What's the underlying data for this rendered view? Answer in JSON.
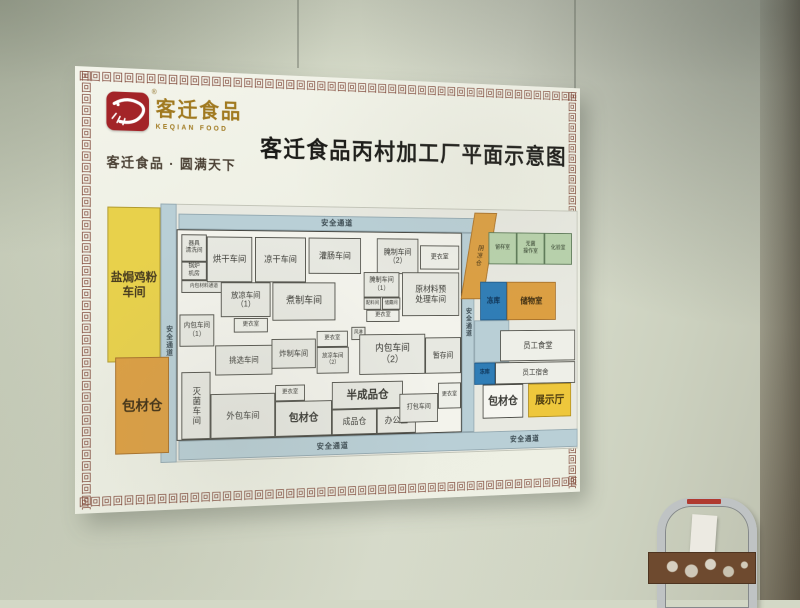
{
  "header": {
    "logo_cn": "客迁食品",
    "logo_en": "KEQIAN FOOD",
    "registered_mark": "®",
    "tagline": "客迁食品 · 圆满天下",
    "title": "客迁食品丙村加工厂平面示意图"
  },
  "palette": {
    "passage_blue": "#b9cfd6",
    "workshop_yellow": "#e8d14b",
    "warehouse_orange": "#dc9f42",
    "freezer_blue": "#2f7db6",
    "lab_green": "#b8d2ac",
    "exhibition_gold": "#eec73c",
    "logo_red": "#a32428",
    "logo_gold": "#a0791f",
    "fret_brown": "#7d4334"
  },
  "plan": {
    "passage_label": "安全通道",
    "blocks": [
      {
        "name": "plan-backdrop",
        "label": "",
        "x": 103,
        "y": 136,
        "w": 462,
        "h": 264,
        "cls": "backdrop"
      },
      {
        "name": "passage-left",
        "label": "",
        "x": 88,
        "y": 136,
        "w": 17,
        "h": 264,
        "cls": "passage"
      },
      {
        "name": "passage-top",
        "label": "",
        "x": 107,
        "y": 146,
        "w": 340,
        "h": 16,
        "cls": "passage"
      },
      {
        "name": "passage-bottom",
        "label": "",
        "x": 107,
        "y": 378,
        "w": 458,
        "h": 20,
        "cls": "passage"
      },
      {
        "name": "passage-right",
        "label": "",
        "x": 424,
        "y": 162,
        "w": 15,
        "h": 216,
        "cls": "passage"
      },
      {
        "name": "block-salt-baked-chicken-powder-workshop",
        "label": "盐焗鸡粉\n车间",
        "x": 33,
        "y": 140,
        "w": 55,
        "h": 157,
        "cls": "yellow",
        "fs": 12,
        "bold": true
      },
      {
        "name": "block-packaging-warehouse-left",
        "label": "包材仓",
        "x": 41,
        "y": 292,
        "w": 56,
        "h": 98,
        "cls": "orangeBig",
        "fs": 14,
        "bold": true
      },
      {
        "name": "main-building",
        "label": "",
        "x": 105,
        "y": 162,
        "w": 319,
        "h": 216,
        "cls": "building"
      },
      {
        "name": "room-utensil-washing",
        "label": "器具\n清洗间",
        "x": 110,
        "y": 167,
        "w": 27,
        "h": 28,
        "cls": "room",
        "fs": 6
      },
      {
        "name": "room-boiler",
        "label": "锅炉\n机房",
        "x": 110,
        "y": 195,
        "w": 27,
        "h": 19,
        "cls": "room",
        "fs": 6
      },
      {
        "name": "room-inner-pack-material-corridor",
        "label": "内包材料通道",
        "x": 110,
        "y": 214,
        "w": 48,
        "h": 13,
        "cls": "room",
        "fs": 5
      },
      {
        "name": "room-drying-workshop",
        "label": "烘干车间",
        "x": 137,
        "y": 169,
        "w": 49,
        "h": 47,
        "cls": "room",
        "fs": 9
      },
      {
        "name": "room-cool-dry-workshop",
        "label": "凉干车间",
        "x": 189,
        "y": 169,
        "w": 56,
        "h": 47,
        "cls": "room",
        "fs": 9
      },
      {
        "name": "room-sausage-filling-workshop",
        "label": "灌肠车间",
        "x": 248,
        "y": 169,
        "w": 59,
        "h": 38,
        "cls": "room",
        "fs": 9
      },
      {
        "name": "room-curing-workshop-2",
        "label": "腌制车间\n（2）",
        "x": 325,
        "y": 169,
        "w": 48,
        "h": 38,
        "cls": "room",
        "fs": 8
      },
      {
        "name": "room-changing-a",
        "label": "更衣室",
        "x": 375,
        "y": 176,
        "w": 46,
        "h": 26,
        "cls": "roomlight",
        "fs": 7
      },
      {
        "name": "room-cooling-workshop-1",
        "label": "放凉车间\n（1）",
        "x": 152,
        "y": 216,
        "w": 54,
        "h": 36,
        "cls": "room",
        "fs": 8
      },
      {
        "name": "room-boiling-workshop",
        "label": "煮制车间",
        "x": 208,
        "y": 216,
        "w": 70,
        "h": 40,
        "cls": "room",
        "fs": 10
      },
      {
        "name": "room-curing-workshop-1",
        "label": "腌制车间\n（1）",
        "x": 310,
        "y": 205,
        "w": 41,
        "h": 27,
        "cls": "room",
        "fs": 7
      },
      {
        "name": "room-ingredient",
        "label": "配料间",
        "x": 310,
        "y": 232,
        "w": 20,
        "h": 13,
        "cls": "room",
        "fs": 5
      },
      {
        "name": "room-storage-small",
        "label": "储藏间",
        "x": 331,
        "y": 232,
        "w": 21,
        "h": 13,
        "cls": "room",
        "fs": 5
      },
      {
        "name": "room-changing-b",
        "label": "更衣室",
        "x": 313,
        "y": 245,
        "w": 38,
        "h": 13,
        "cls": "roomlight",
        "fs": 6
      },
      {
        "name": "room-raw-material-pretreatment",
        "label": "原材料预\n处理车间",
        "x": 354,
        "y": 205,
        "w": 67,
        "h": 47,
        "cls": "room",
        "fs": 9
      },
      {
        "name": "room-inner-packing-1",
        "label": "内包车间\n（1）",
        "x": 108,
        "y": 249,
        "w": 37,
        "h": 33,
        "cls": "room",
        "fs": 7
      },
      {
        "name": "room-changing-c",
        "label": "更衣室",
        "x": 166,
        "y": 253,
        "w": 37,
        "h": 15,
        "cls": "roomlight",
        "fs": 6
      },
      {
        "name": "room-selection-workshop",
        "label": "挑选车间",
        "x": 146,
        "y": 281,
        "w": 62,
        "h": 31,
        "cls": "room",
        "fs": 8
      },
      {
        "name": "room-frying-workshop",
        "label": "炸制车间",
        "x": 207,
        "y": 275,
        "w": 49,
        "h": 31,
        "cls": "room",
        "fs": 8
      },
      {
        "name": "room-changing-d",
        "label": "更衣室",
        "x": 257,
        "y": 267,
        "w": 35,
        "h": 17,
        "cls": "roomlight",
        "fs": 6
      },
      {
        "name": "room-air-shower",
        "label": "风淋",
        "x": 296,
        "y": 263,
        "w": 16,
        "h": 14,
        "cls": "room",
        "fs": 5
      },
      {
        "name": "room-cooling-workshop-2",
        "label": "放凉车间\n（2）",
        "x": 257,
        "y": 284,
        "w": 36,
        "h": 28,
        "cls": "room",
        "fs": 6
      },
      {
        "name": "room-inner-packing-2",
        "label": "内包车间\n（2）",
        "x": 305,
        "y": 271,
        "w": 76,
        "h": 43,
        "cls": "room",
        "fs": 10
      },
      {
        "name": "room-temp-storage",
        "label": "暂存间",
        "x": 381,
        "y": 275,
        "w": 42,
        "h": 39,
        "cls": "room",
        "fs": 8
      },
      {
        "name": "room-sterilization-workshop",
        "label": "灭菌车间",
        "x": 110,
        "y": 308,
        "w": 31,
        "h": 69,
        "cls": "room",
        "fs": 9,
        "vert": true
      },
      {
        "name": "room-outer-packing-workshop",
        "label": "外包车间",
        "x": 141,
        "y": 331,
        "w": 70,
        "h": 46,
        "cls": "room",
        "fs": 9
      },
      {
        "name": "room-changing-e",
        "label": "更衣室",
        "x": 211,
        "y": 323,
        "w": 33,
        "h": 17,
        "cls": "roomlight",
        "fs": 6
      },
      {
        "name": "room-packaging-warehouse-main",
        "label": "包材仓",
        "x": 211,
        "y": 340,
        "w": 63,
        "h": 37,
        "cls": "room",
        "fs": 11,
        "bold": true
      },
      {
        "name": "room-semi-finished-warehouse",
        "label": "半成品仓",
        "x": 274,
        "y": 321,
        "w": 81,
        "h": 29,
        "cls": "room",
        "fs": 12,
        "bold": true
      },
      {
        "name": "room-finished-goods-warehouse",
        "label": "成品仓",
        "x": 274,
        "y": 350,
        "w": 51,
        "h": 27,
        "cls": "room",
        "fs": 9
      },
      {
        "name": "room-office",
        "label": "办公室",
        "x": 325,
        "y": 350,
        "w": 45,
        "h": 27,
        "cls": "room",
        "fs": 9
      },
      {
        "name": "room-packing-workshop",
        "label": "打包车间",
        "x": 351,
        "y": 335,
        "w": 45,
        "h": 31,
        "cls": "room",
        "fs": 7
      },
      {
        "name": "room-changing-f",
        "label": "更衣室",
        "x": 396,
        "y": 324,
        "w": 27,
        "h": 28,
        "cls": "roomlight",
        "fs": 6
      },
      {
        "name": "strip-shaded-warehouse",
        "label": "阴凉仓",
        "x": 431,
        "y": 140,
        "w": 27,
        "h": 94,
        "cls": "orangeBig",
        "fs": 7,
        "vert": true,
        "skew": -10
      },
      {
        "name": "room-sample",
        "label": "留样室",
        "x": 456,
        "y": 161,
        "w": 34,
        "h": 35,
        "cls": "green",
        "fs": 6
      },
      {
        "name": "room-sterile-operation",
        "label": "无菌\n操作室",
        "x": 490,
        "y": 161,
        "w": 34,
        "h": 35,
        "cls": "green",
        "fs": 6
      },
      {
        "name": "room-lab",
        "label": "化验室",
        "x": 524,
        "y": 161,
        "w": 34,
        "h": 35,
        "cls": "green",
        "fs": 6
      },
      {
        "name": "room-freezer-1",
        "label": "冻库",
        "x": 446,
        "y": 215,
        "w": 32,
        "h": 42,
        "cls": "blue",
        "fs": 8
      },
      {
        "name": "room-storage",
        "label": "储物室",
        "x": 478,
        "y": 215,
        "w": 60,
        "h": 42,
        "cls": "orangeBig",
        "fs": 9,
        "bold": true
      },
      {
        "name": "annex-yard",
        "label": "",
        "x": 439,
        "y": 257,
        "w": 42,
        "h": 46,
        "cls": "passage"
      },
      {
        "name": "room-staff-canteen",
        "label": "员工食堂",
        "x": 470,
        "y": 268,
        "w": 92,
        "h": 34,
        "cls": "roomlight",
        "fs": 9
      },
      {
        "name": "room-freezer-2",
        "label": "冻库",
        "x": 439,
        "y": 303,
        "w": 25,
        "h": 24,
        "cls": "blue",
        "fs": 6
      },
      {
        "name": "room-staff-dormitory",
        "label": "员工宿舍",
        "x": 464,
        "y": 303,
        "w": 98,
        "h": 24,
        "cls": "roomlight",
        "fs": 8
      },
      {
        "name": "room-packaging-warehouse-annex",
        "label": "包材仓",
        "x": 449,
        "y": 327,
        "w": 49,
        "h": 37,
        "cls": "white",
        "fs": 12,
        "bold": true
      },
      {
        "name": "room-exhibition-hall",
        "label": "展示厅",
        "x": 504,
        "y": 327,
        "w": 53,
        "h": 37,
        "cls": "gold",
        "fs": 12,
        "bold": true
      },
      {
        "name": "label-passage-top",
        "label": "安全通道",
        "x": 250,
        "y": 147,
        "w": 60,
        "h": 14,
        "cls": "labelonly",
        "fs": 8
      },
      {
        "name": "label-passage-bottom-main",
        "label": "安全通道",
        "x": 240,
        "y": 381,
        "w": 70,
        "h": 15,
        "cls": "labelonly",
        "fs": 8
      },
      {
        "name": "label-passage-bottom-annex",
        "label": "安全通道",
        "x": 465,
        "y": 380,
        "w": 70,
        "h": 15,
        "cls": "labelonly",
        "fs": 8
      },
      {
        "name": "label-passage-left",
        "label": "安全通道",
        "x": 88,
        "y": 245,
        "w": 17,
        "h": 62,
        "cls": "labelonly",
        "fs": 7,
        "vert": true
      },
      {
        "name": "label-passage-right",
        "label": "安全通道",
        "x": 424,
        "y": 228,
        "w": 15,
        "h": 62,
        "cls": "labelonly",
        "fs": 7,
        "vert": true
      }
    ]
  }
}
